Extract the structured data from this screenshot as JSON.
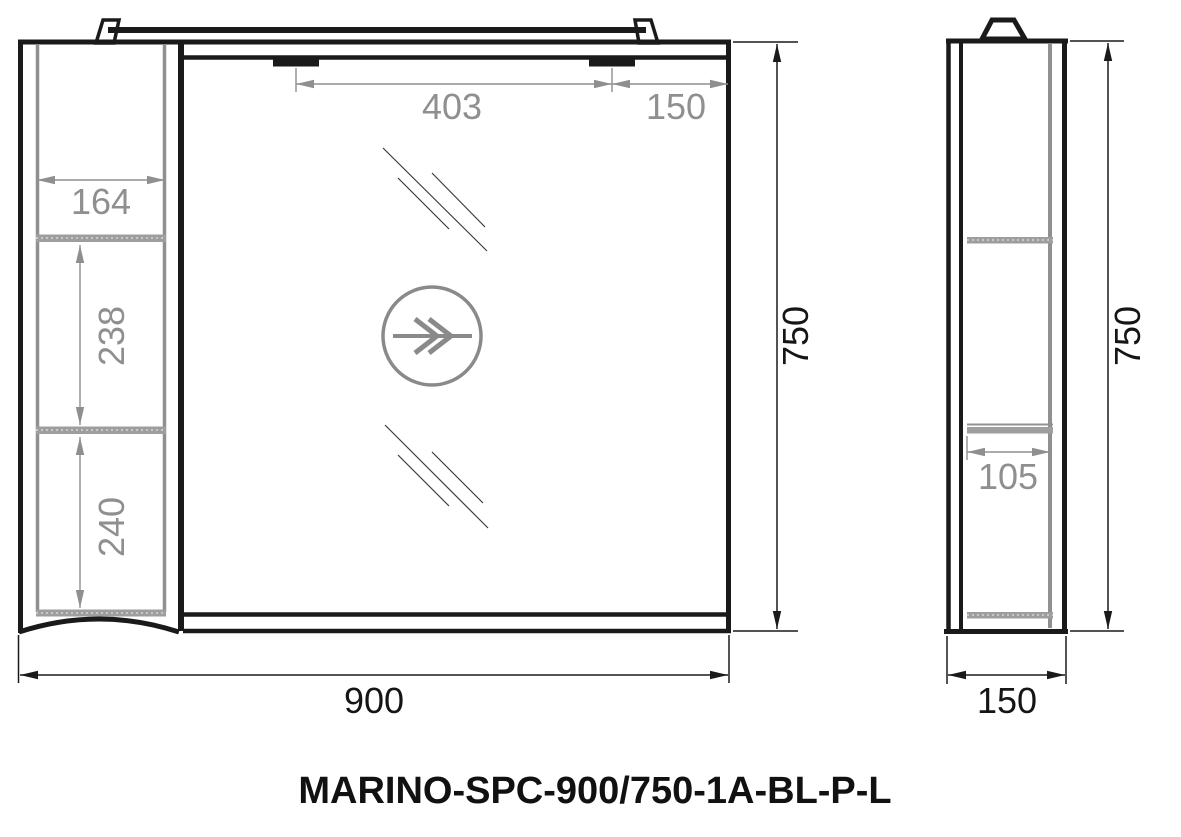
{
  "drawing": {
    "title": "MARINO-SPC-900/750-1A-BL-P-L",
    "views": {
      "front": {
        "name": "front-view",
        "dimensions": {
          "overall_width": "900",
          "overall_height": "750",
          "hinge_spacing": "403",
          "hinge_to_edge": "150",
          "side_shelf_width": "164",
          "shelf_spacing_upper": "238",
          "shelf_spacing_lower": "240"
        }
      },
      "side": {
        "name": "side-view",
        "dimensions": {
          "overall_depth": "150",
          "overall_height": "750",
          "shelf_depth": "105"
        }
      }
    },
    "symbols": {
      "door_swing": "double-arrow-circle"
    },
    "colors": {
      "ink": "#1a1a1a",
      "dimension_gray": "#8f8f8f",
      "shelf_gray": "#9e9e9e",
      "background": "#ffffff"
    }
  }
}
